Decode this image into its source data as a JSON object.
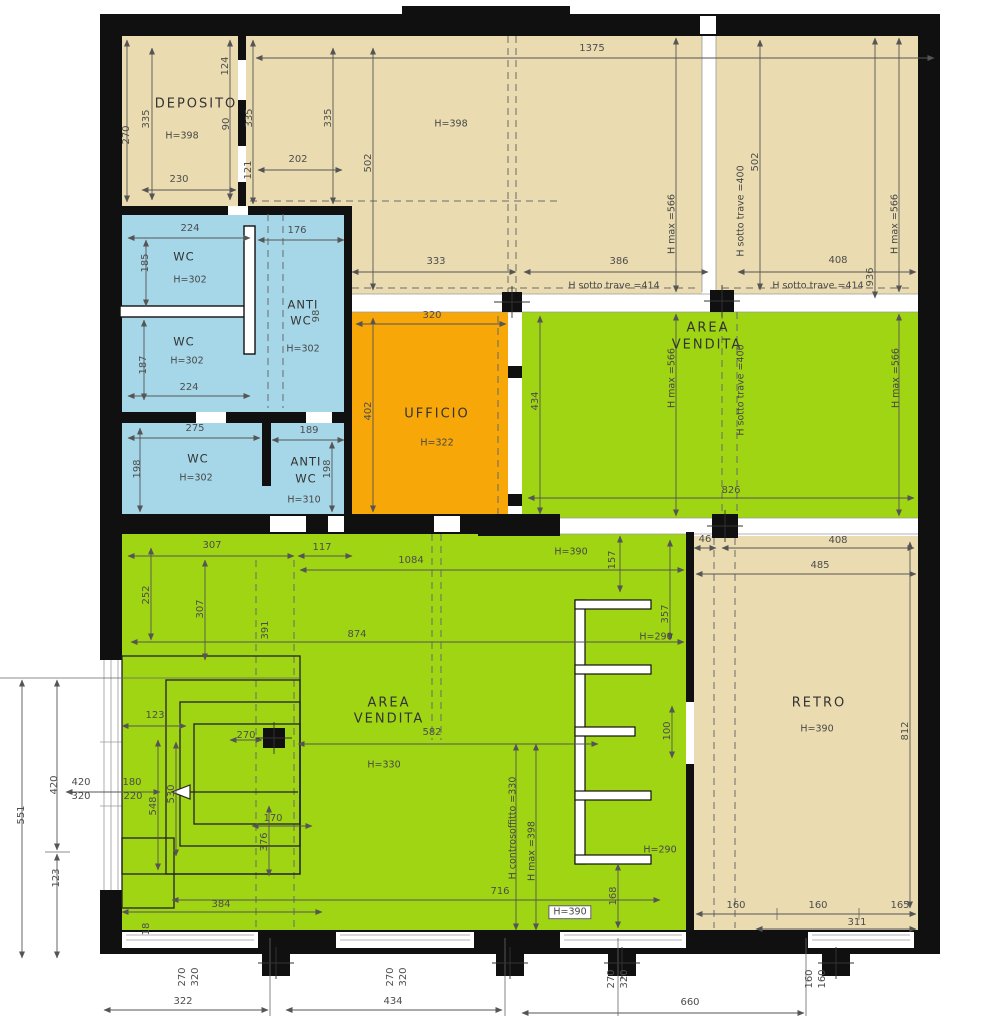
{
  "title": "Planimetria locale commerciale",
  "colors": {
    "beige": "#EADCB0",
    "blue": "#A6D7E8",
    "orange": "#F7A707",
    "green": "#A0D513",
    "wall": "#101010",
    "dim_text": "#4d4d4d"
  },
  "rooms": [
    {
      "name": "DEPOSITO",
      "height": "H=398"
    },
    {
      "name": "WC",
      "height": "H=302"
    },
    {
      "name": "WC",
      "height": "H=302"
    },
    {
      "name": "ANTI WC",
      "height": "H=302"
    },
    {
      "name": "WC",
      "height": "H=302"
    },
    {
      "name": "ANTI WC",
      "height": "H=310"
    },
    {
      "name": "UFFICIO",
      "height": "H=322"
    },
    {
      "name": "AREA VENDITA",
      "height": "H max =566"
    },
    {
      "name": "AREA VENDITA",
      "height": "H=330"
    },
    {
      "name": "RETRO",
      "height": "H=390"
    }
  ],
  "beam_notes": [
    "H sotto trave =414",
    "H sotto trave =400",
    "H max =566",
    "H controsoffitto =330",
    "H max =398"
  ],
  "labels": [
    {
      "t": "DEPOSITO",
      "x": 196,
      "y": 104,
      "s": "room"
    },
    {
      "t": "H=398",
      "x": 182,
      "y": 136,
      "s": "h"
    },
    {
      "t": "H=398",
      "x": 451,
      "y": 124,
      "s": "h"
    },
    {
      "t": "WC",
      "x": 184,
      "y": 257,
      "s": "room2"
    },
    {
      "t": "H=302",
      "x": 190,
      "y": 280,
      "s": "h"
    },
    {
      "t": "ANTI",
      "x": 303,
      "y": 305,
      "s": "room2"
    },
    {
      "t": "WC",
      "x": 301,
      "y": 321,
      "s": "room2"
    },
    {
      "t": "98",
      "x": 317,
      "y": 316,
      "r": 1
    },
    {
      "t": "H=302",
      "x": 303,
      "y": 349,
      "s": "h"
    },
    {
      "t": "WC",
      "x": 184,
      "y": 342,
      "s": "room2"
    },
    {
      "t": "H=302",
      "x": 187,
      "y": 361,
      "s": "h"
    },
    {
      "t": "WC",
      "x": 198,
      "y": 459,
      "s": "room2"
    },
    {
      "t": "H=302",
      "x": 196,
      "y": 478,
      "s": "h"
    },
    {
      "t": "ANTI",
      "x": 306,
      "y": 462,
      "s": "room2"
    },
    {
      "t": "WC",
      "x": 306,
      "y": 479,
      "s": "room2"
    },
    {
      "t": "H=310",
      "x": 304,
      "y": 500,
      "s": "h"
    },
    {
      "t": "UFFICIO",
      "x": 437,
      "y": 414,
      "s": "room"
    },
    {
      "t": "H=322",
      "x": 437,
      "y": 443,
      "s": "h"
    },
    {
      "t": "AREA",
      "x": 708,
      "y": 328,
      "s": "room"
    },
    {
      "t": "VENDITA",
      "x": 707,
      "y": 345,
      "s": "room"
    },
    {
      "t": "AREA",
      "x": 389,
      "y": 703,
      "s": "room"
    },
    {
      "t": "VENDITA",
      "x": 389,
      "y": 719,
      "s": "room"
    },
    {
      "t": "H=330",
      "x": 384,
      "y": 765,
      "s": "h"
    },
    {
      "t": "RETRO",
      "x": 819,
      "y": 703,
      "s": "room"
    },
    {
      "t": "H=390",
      "x": 817,
      "y": 729,
      "s": "h"
    },
    {
      "t": "H=390",
      "x": 570,
      "y": 912,
      "s": "hbox"
    },
    {
      "t": "H=390",
      "x": 571,
      "y": 552,
      "s": "h"
    },
    {
      "t": "H=290",
      "x": 656,
      "y": 637,
      "s": "h"
    },
    {
      "t": "H=290",
      "x": 660,
      "y": 850,
      "s": "h"
    },
    {
      "t": "1375",
      "x": 592,
      "y": 49
    },
    {
      "t": "230",
      "x": 179,
      "y": 180
    },
    {
      "t": "202",
      "x": 298,
      "y": 160
    },
    {
      "t": "176",
      "x": 297,
      "y": 231
    },
    {
      "t": "224",
      "x": 190,
      "y": 229
    },
    {
      "t": "224",
      "x": 189,
      "y": 388
    },
    {
      "t": "275",
      "x": 195,
      "y": 429
    },
    {
      "t": "189",
      "x": 309,
      "y": 431
    },
    {
      "t": "320",
      "x": 432,
      "y": 316
    },
    {
      "t": "333",
      "x": 436,
      "y": 262
    },
    {
      "t": "386",
      "x": 619,
      "y": 262
    },
    {
      "t": "408",
      "x": 838,
      "y": 261
    },
    {
      "t": "H sotto trave =414",
      "x": 614,
      "y": 286,
      "s": "h"
    },
    {
      "t": "H sotto trave =414",
      "x": 818,
      "y": 286,
      "s": "h"
    },
    {
      "t": "826",
      "x": 731,
      "y": 491
    },
    {
      "t": "46",
      "x": 705,
      "y": 540
    },
    {
      "t": "408",
      "x": 838,
      "y": 541
    },
    {
      "t": "485",
      "x": 820,
      "y": 566
    },
    {
      "t": "307",
      "x": 212,
      "y": 546
    },
    {
      "t": "117",
      "x": 322,
      "y": 548
    },
    {
      "t": "1084",
      "x": 411,
      "y": 561
    },
    {
      "t": "874",
      "x": 357,
      "y": 635
    },
    {
      "t": "582",
      "x": 432,
      "y": 733
    },
    {
      "t": "123",
      "x": 155,
      "y": 716
    },
    {
      "t": "170",
      "x": 273,
      "y": 819
    },
    {
      "t": "270",
      "x": 246,
      "y": 736
    },
    {
      "t": "384",
      "x": 221,
      "y": 905
    },
    {
      "t": "716",
      "x": 500,
      "y": 892
    },
    {
      "t": "160",
      "x": 736,
      "y": 906
    },
    {
      "t": "160",
      "x": 818,
      "y": 906
    },
    {
      "t": "165",
      "x": 900,
      "y": 906
    },
    {
      "t": "311",
      "x": 857,
      "y": 923
    },
    {
      "t": "322",
      "x": 183,
      "y": 1002
    },
    {
      "t": "434",
      "x": 393,
      "y": 1002
    },
    {
      "t": "660",
      "x": 690,
      "y": 1003
    },
    {
      "t": "420",
      "x": 81,
      "y": 783
    },
    {
      "t": "320",
      "x": 81,
      "y": 797
    },
    {
      "t": "180",
      "x": 132,
      "y": 783
    },
    {
      "t": "220",
      "x": 133,
      "y": 797
    },
    {
      "t": "270",
      "x": 127,
      "y": 135,
      "r": 1
    },
    {
      "t": "335",
      "x": 147,
      "y": 119,
      "r": 1
    },
    {
      "t": "124",
      "x": 226,
      "y": 66,
      "r": 1
    },
    {
      "t": "90",
      "x": 227,
      "y": 124,
      "r": 1
    },
    {
      "t": "121",
      "x": 249,
      "y": 170,
      "r": 1
    },
    {
      "t": "335",
      "x": 250,
      "y": 118,
      "r": 1
    },
    {
      "t": "335",
      "x": 329,
      "y": 118,
      "r": 1
    },
    {
      "t": "502",
      "x": 369,
      "y": 163,
      "r": 1
    },
    {
      "t": "502",
      "x": 756,
      "y": 162,
      "r": 1
    },
    {
      "t": "936",
      "x": 871,
      "y": 277,
      "r": 1
    },
    {
      "t": "H max =566",
      "x": 672,
      "y": 224,
      "r": 1,
      "s": "h"
    },
    {
      "t": "H max =566",
      "x": 895,
      "y": 224,
      "r": 1,
      "s": "h"
    },
    {
      "t": "H sotto trave =400",
      "x": 741,
      "y": 211,
      "r": 1,
      "s": "h"
    },
    {
      "t": "H sotto trave =400",
      "x": 741,
      "y": 390,
      "r": 1,
      "s": "h"
    },
    {
      "t": "H max =566",
      "x": 672,
      "y": 378,
      "r": 1,
      "s": "h"
    },
    {
      "t": "H max =566",
      "x": 896,
      "y": 378,
      "r": 1,
      "s": "h"
    },
    {
      "t": "185",
      "x": 146,
      "y": 263,
      "r": 1
    },
    {
      "t": "187",
      "x": 144,
      "y": 365,
      "r": 1
    },
    {
      "t": "198",
      "x": 138,
      "y": 469,
      "r": 1
    },
    {
      "t": "198",
      "x": 328,
      "y": 469,
      "r": 1
    },
    {
      "t": "402",
      "x": 369,
      "y": 411,
      "r": 1
    },
    {
      "t": "434",
      "x": 536,
      "y": 401,
      "r": 1
    },
    {
      "t": "252",
      "x": 147,
      "y": 595,
      "r": 1
    },
    {
      "t": "307",
      "x": 201,
      "y": 609,
      "r": 1
    },
    {
      "t": "391",
      "x": 266,
      "y": 630,
      "r": 1
    },
    {
      "t": "157",
      "x": 613,
      "y": 560,
      "r": 1
    },
    {
      "t": "357",
      "x": 666,
      "y": 614,
      "r": 1
    },
    {
      "t": "100",
      "x": 668,
      "y": 731,
      "r": 1
    },
    {
      "t": "812",
      "x": 906,
      "y": 731,
      "r": 1
    },
    {
      "t": "548",
      "x": 154,
      "y": 806,
      "r": 1
    },
    {
      "t": "530",
      "x": 172,
      "y": 794,
      "r": 1
    },
    {
      "t": "376",
      "x": 265,
      "y": 842,
      "r": 1
    },
    {
      "t": "168",
      "x": 614,
      "y": 896,
      "r": 1
    },
    {
      "t": "H controsoffitto =330",
      "x": 513,
      "y": 828,
      "r": 1,
      "s": "h"
    },
    {
      "t": "H max =398",
      "x": 532,
      "y": 851,
      "r": 1,
      "s": "h"
    },
    {
      "t": "551",
      "x": 22,
      "y": 815,
      "r": 1
    },
    {
      "t": "420",
      "x": 55,
      "y": 785,
      "r": 1
    },
    {
      "t": "123",
      "x": 57,
      "y": 878,
      "r": 1
    },
    {
      "t": "270",
      "x": 183,
      "y": 977,
      "r": 1
    },
    {
      "t": "320",
      "x": 196,
      "y": 977,
      "r": 1
    },
    {
      "t": "270",
      "x": 391,
      "y": 977,
      "r": 1
    },
    {
      "t": "320",
      "x": 404,
      "y": 977,
      "r": 1
    },
    {
      "t": "270",
      "x": 612,
      "y": 979,
      "r": 1
    },
    {
      "t": "320",
      "x": 625,
      "y": 979,
      "r": 1
    },
    {
      "t": "160",
      "x": 810,
      "y": 979,
      "r": 1
    },
    {
      "t": "160",
      "x": 823,
      "y": 979,
      "r": 1
    },
    {
      "t": "18",
      "x": 147,
      "y": 929,
      "r": 1
    }
  ]
}
